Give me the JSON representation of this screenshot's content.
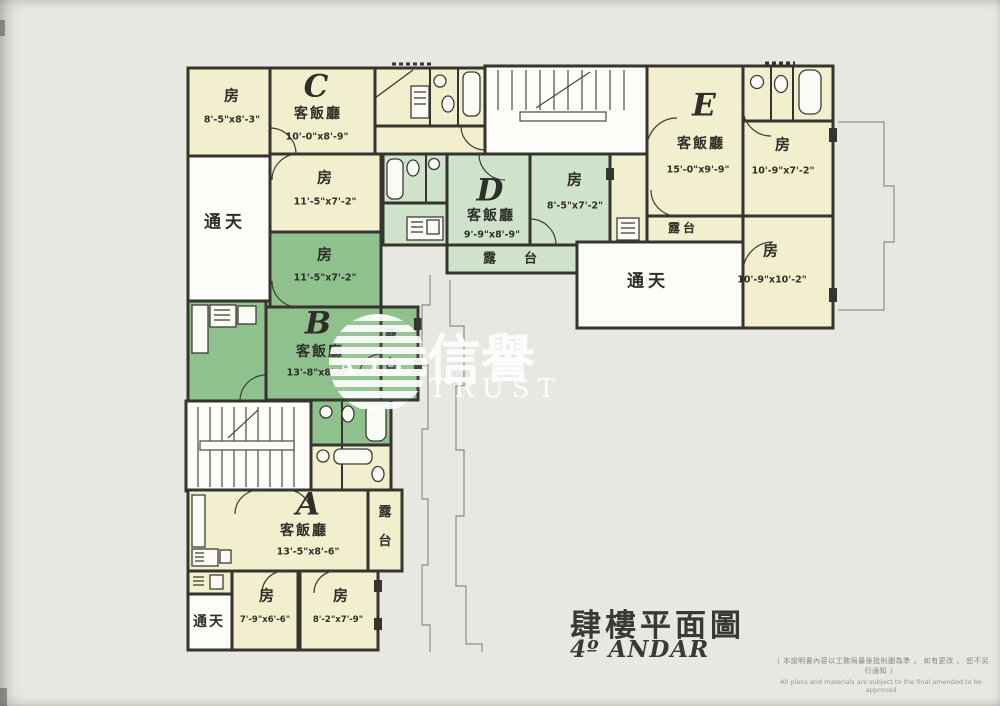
{
  "document": {
    "type": "floor-plan-scan",
    "title_cjk": "肆樓平面圖",
    "title_latin": "4º ANDAR",
    "disclaimer_cjk": "（ 本說明書內容以工務局最後批則圖為準 ， 如有更改 ， 恕不另行通知 ）",
    "disclaimer_en": "All plans and materials are subject to the final amended to be approved"
  },
  "watermark": {
    "monogram": "A.T.T.",
    "cjk": "信譽",
    "latin": "TRUST"
  },
  "labels": {
    "room": "房",
    "living_dining": "客飯廳",
    "lightwell": "通天",
    "balcony": "露台",
    "balcony_char_1": "露",
    "balcony_char_2": "台"
  },
  "units": {
    "a": {
      "letter": "A",
      "living_dim": "13'-5\"x8'-6\"",
      "bed1_dim": "7'-9\"x6'-6\"",
      "bed2_dim": "8'-2\"x7'-9\""
    },
    "b": {
      "letter": "B",
      "living_dim": "13'-8\"x8'-6\"",
      "bed1_dim": "11'-5\"x7'-2\""
    },
    "c": {
      "letter": "C",
      "living_dim": "10'-0\"x8'-9\"",
      "bed1_dim": "8'-5\"x8'-3\"",
      "bed2_dim": "11'-5\"x7'-2\""
    },
    "d": {
      "letter": "D",
      "living_dim": "9'-9\"x8'-9\"",
      "bed1_dim": "8'-5\"x7'-2\""
    },
    "e": {
      "letter": "E",
      "living_dim": "15'-0\"x9'-9\"",
      "bed1_dim": "10'-9\"x7'-2\"",
      "bed2_dim": "10'-9\"x10'-2\""
    }
  },
  "colors": {
    "paper": "#e9e7e1",
    "room_cream": "#f2efce",
    "room_light_green": "#cfe3ca",
    "room_green": "#8fc18d",
    "wall": "#35342e",
    "faint_outline": "#8f8d85"
  }
}
